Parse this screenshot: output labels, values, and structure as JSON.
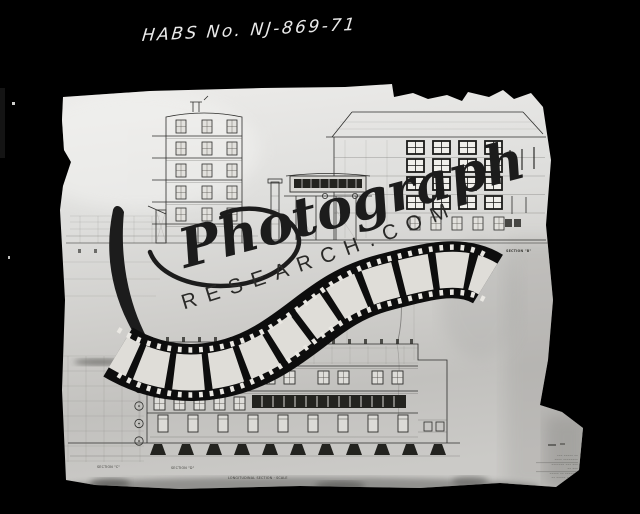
{
  "annotation": {
    "text": "HABS No. NJ-869-71"
  },
  "watermark": {
    "script": "Photograph",
    "arc": "RESEARCH.COM"
  },
  "drawing": {
    "labels": {
      "section_b": "SECTION \"B\"",
      "section_c": "SECTION \"C\"",
      "section_d": "SECTION \"D\"",
      "scale_note": "LONGITUDINAL SECTION · SCALE"
    },
    "title_block_lines": [
      "––– ––––– ––",
      "–––– ––––––––",
      "––––––– ––– –––",
      "–– –––",
      "––––– –– –––––––",
      "–– ––––– ––––––"
    ]
  },
  "colors": {
    "background": "#000000",
    "paper": "#d8d7d4",
    "ink": "#2e2e2c",
    "film_black": "#0d0d0d",
    "film_frame": "#ebe9e4",
    "watermark_ink": "#1c1c1c",
    "annotation_white": "#e9e9e9"
  }
}
